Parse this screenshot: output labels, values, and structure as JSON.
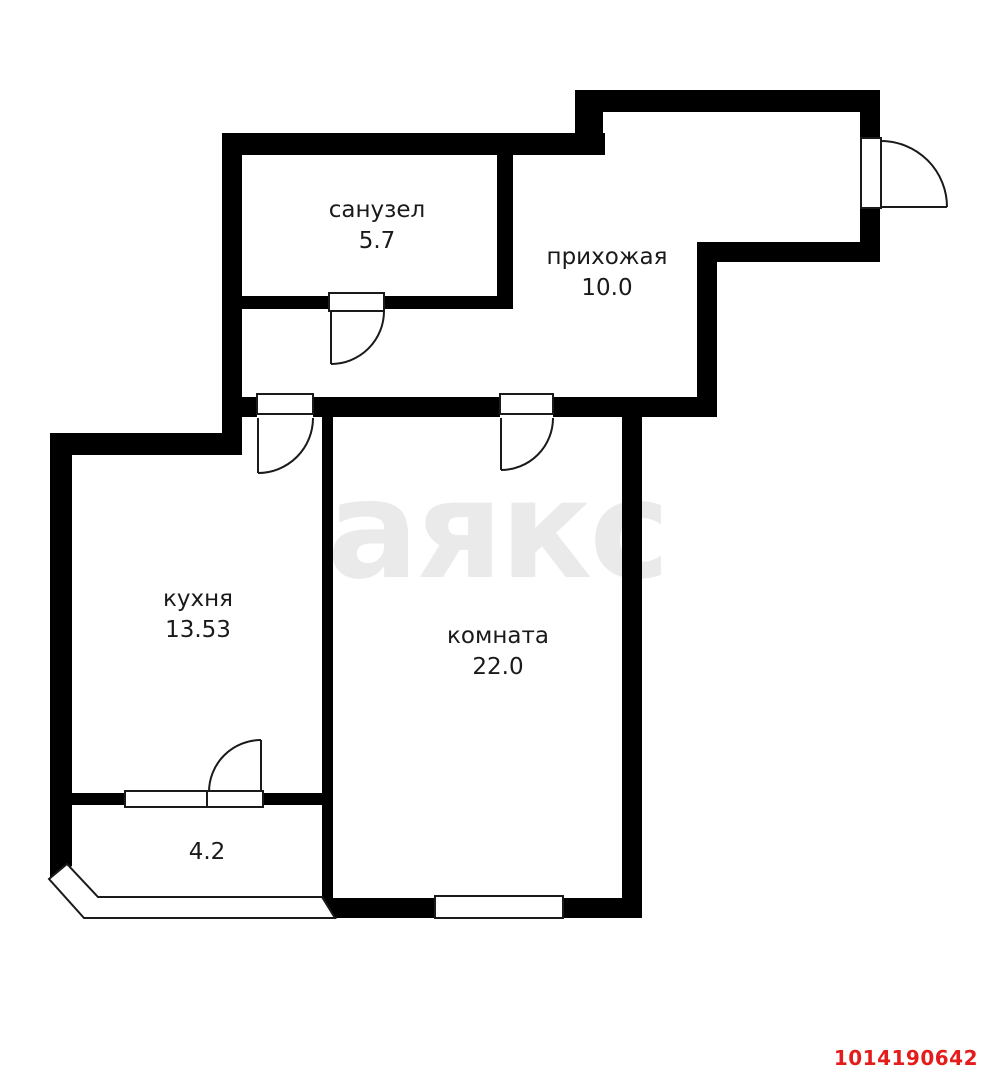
{
  "plan": {
    "rooms": [
      {
        "key": "bathroom",
        "label": "санузел",
        "area": "5.7"
      },
      {
        "key": "hallway",
        "label": "прихожая",
        "area": "10.0"
      },
      {
        "key": "kitchen",
        "label": "кухня",
        "area": "13.53"
      },
      {
        "key": "room",
        "label": "комната",
        "area": "22.0"
      },
      {
        "key": "balcony",
        "label": "",
        "area": "4.2"
      }
    ],
    "watermark": "аякс",
    "listing_id": "1014190642"
  },
  "colors": {
    "background": "#ffffff",
    "wall": "#000000",
    "door_line": "#1a1a1a",
    "watermark": "#eaeaea",
    "listing_id": "#e41c1c"
  }
}
